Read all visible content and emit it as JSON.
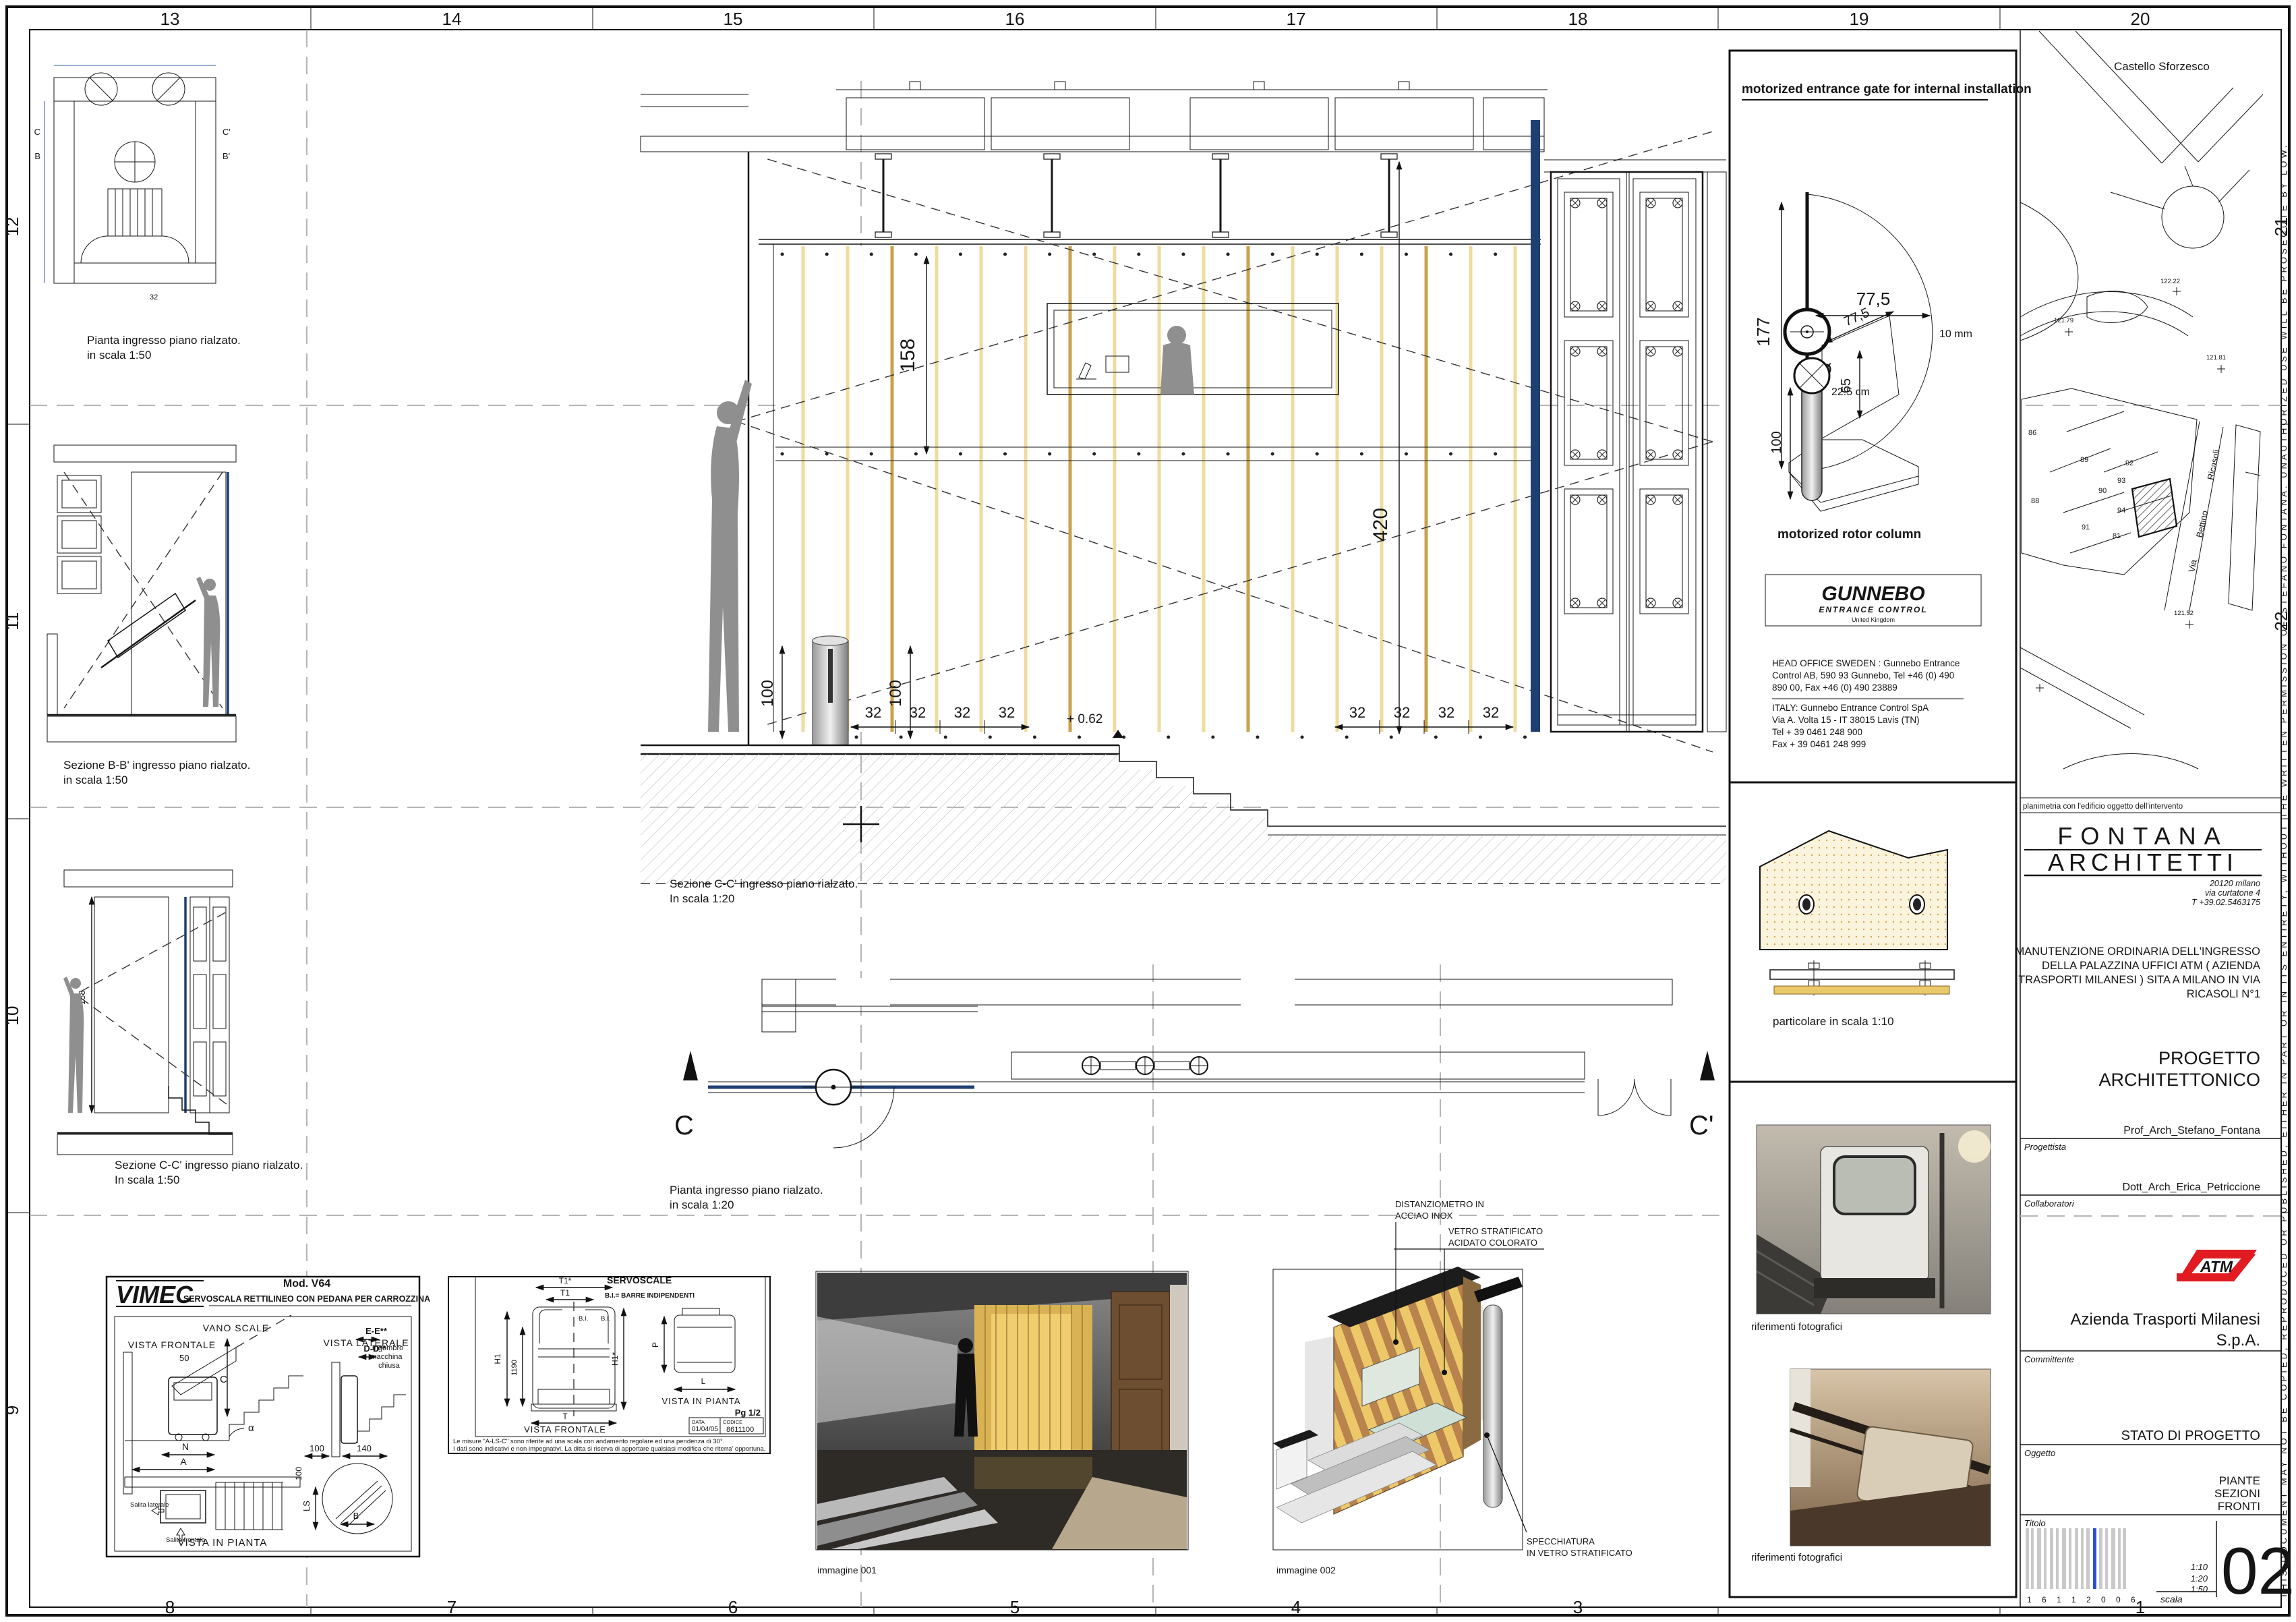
{
  "colors": {
    "plan_blue": "#2c5fae",
    "fin_blue": "#1d3f73",
    "gunnebo_blue": "#0a7cc4",
    "atm_red": "#e01b22",
    "glass_yellow": "#efdb9e",
    "barcode_blue": "#2b50d8"
  },
  "sheet": {
    "grid": {
      "top": [
        "13",
        "14",
        "15",
        "16",
        "17",
        "18",
        "19",
        "20"
      ],
      "bottom": [
        "8",
        "7",
        "6",
        "5",
        "4",
        "3",
        "1"
      ],
      "left": [
        "12",
        "11",
        "10",
        "9"
      ],
      "right": [
        "21",
        "22"
      ]
    },
    "notice": "THIS DOCUMENT MAY NOT BE COPIED, REPRODUCED OR PUBLISHED, EITHER IN PART OR IN ITS ENTIRETY, WITHOUT THE WRITTEN PERMISSION OF STEFANO FONTANA. UNAUTHORIZED USE WILL BE PROSECUTE BY LOW."
  },
  "left_col": {
    "plan50": {
      "cap1": "Pianta ingresso piano rialzato.",
      "cap2": "in scala 1:50",
      "m_c": "C",
      "m_b": "B",
      "m_c2": "C'",
      "m_b2": "B'",
      "dim32": "32"
    },
    "sezb": {
      "cap1": "Sezione B-B' ingresso piano rialzato.",
      "cap2": "in scala 1:50"
    },
    "sezc": {
      "cap1": "Sezione C-C' ingresso piano rialzato.",
      "cap2": "In scala 1:50",
      "dim158": "158"
    }
  },
  "center": {
    "section": {
      "cap1": "Sezione C-C' ingresso piano rialzato.",
      "cap2": "In scala 1:20",
      "dim158": "158",
      "dim420": "420",
      "dim100a": "100",
      "dim100b": "100",
      "d32": [
        "32",
        "32",
        "32",
        "32",
        "32",
        "32",
        "32",
        "32"
      ],
      "level": "+ 0.62"
    },
    "plan": {
      "cap1": "Pianta ingresso piano rialzato.",
      "cap2": "in scala 1:20",
      "mc": "C",
      "mc2": "C'"
    }
  },
  "images": {
    "img1": {
      "caption": "immagine 001"
    },
    "img2": {
      "caption": "immagine 002",
      "ann1a": "DISTANZIOMETRO IN",
      "ann1b": "ACCIAO INOX",
      "ann2a": "VETRO STRATIFICATO",
      "ann2b": "ACIDATO COLORATO",
      "ann3a": "SPECCHIATURA",
      "ann3b": "IN VETRO STRATIFICATO"
    }
  },
  "vimec": {
    "brand": "VIMEC",
    "model": "Mod. V64",
    "subtitle": "SERVOSCALA RETTILINEO CON PEDANA PER CARROZZINA",
    "vano": "VANO SCALE",
    "vfront": "VISTA FRONTALE",
    "vlat": "VISTA LATERALE",
    "ee": "E-E**",
    "dd": "D-D**",
    "ing1": "Ingombro",
    "ing2": "macchina",
    "ing3": "chiusa",
    "d50": "50",
    "dc": "C",
    "alpha": "α",
    "dn": "N",
    "da": "A",
    "d100a": "100",
    "d140": "140",
    "d100b": "100",
    "dls": "LS",
    "db": "B",
    "sal_lat": "Salita laterale",
    "sal_front": "Salita frontale",
    "vpianta": "VISTA IN PIANTA"
  },
  "servo": {
    "title": "SERVOSCALE",
    "bi": "B.I.= BARRE INDIPENDENTI",
    "t1s": "T1*",
    "t1": "T1",
    "bia": "B.I.",
    "bib": "B.I.",
    "h1": "H1",
    "d1190": "1190",
    "h1s": "H1*",
    "t": "T",
    "vfront": "VISTA FRONTALE",
    "p": "P",
    "l": "L",
    "vpianta": "VISTA IN PIANTA",
    "pg": "Pg 1/2",
    "data_l": "DATA",
    "data_v": "01/04/05",
    "cod_l": "CODICE",
    "cod_v": "8611100",
    "note1": "Le misure \"A-LS-C\" sono riferite ad una scala con andamento regolare ed una pendenza di 30°.",
    "note2": "I dati sono indicativi e non impegnativi. La ditta si riserva di apportare qualsiasi modifica che riterra' opportuna."
  },
  "gate": {
    "title": "motorized entrance gate for internal installation",
    "d775": "77,5",
    "d10mm": "10 mm",
    "d177": "177",
    "diam": "Ø",
    "d225": "22.5 cm",
    "a775": "77,5",
    "a65": "65",
    "a100": "100",
    "rotor": "motorized rotor column",
    "gunnebo": "GUNNEBO",
    "gsub": "ENTRANCE CONTROL",
    "guk": "United Kingdom",
    "sw1": "HEAD OFFICE SWEDEN : Gunnebo Entrance",
    "sw2": "Control AB, 590 93  Gunnebo, Tel +46 (0) 490",
    "sw3": "890 00, Fax +46 (0) 490 23889",
    "it1": "ITALY: Gunnebo Entrance Control SpA",
    "it2": "Via A. Volta 15 - IT 38015 Lavis (TN)",
    "it3": "Tel + 39 0461 248 900",
    "it4": "Fax + 39 0461 248 999"
  },
  "partic": {
    "caption": "particolare in scala 1:10"
  },
  "photos": {
    "cap1": "riferimenti fotografici",
    "cap2": "riferimenti fotografici"
  },
  "map": {
    "landmark": "Castello Sforzesco",
    "e1": "122.22",
    "e2": "121.79",
    "e3": "121.81",
    "e4": "121.52",
    "b": [
      "86",
      "89",
      "92",
      "93",
      "90",
      "88",
      "94",
      "91",
      "81"
    ],
    "s1": "Ricasoli",
    "s2": "Bettino",
    "s3": "Via",
    "caption": "planimetria con l'edificio oggetto dell'intervento"
  },
  "tb": {
    "studio1": "FONTANA",
    "studio2": "ARCHITETTI",
    "addr1": "20120 milano",
    "addr2": "via curtatone 4",
    "addr3": "T +39.02.5463175",
    "desc1": "MANUTENZIONE ORDINARIA DELL'INGRESSO",
    "desc2": "DELLA PALAZZINA UFFICI ATM ( AZIENDA",
    "desc3": "TRASPORTI MILANESI ) SITA A MILANO IN VIA",
    "desc4": "RICASOLI N°1",
    "proj1": "PROGETTO",
    "proj2": "ARCHITETTONICO",
    "prog_name": "Prof_Arch_Stefano_Fontana",
    "prog_label": "Progettista",
    "coll_name": "Dott_Arch_Erica_Petriccione",
    "coll_label": "Collaboratori",
    "atm": "ATM",
    "comm1": "Azienda Trasporti Milanesi",
    "comm2": "S.p.A.",
    "comm_label": "Committente",
    "stato": "STATO DI PROGETTO",
    "oggetto": "Oggetto",
    "tit1": "PIANTE",
    "tit2": "SEZIONI",
    "tit3": "FRONTI",
    "tit_label": "Titolo",
    "barcode": "1 6 1 1 2 0 0 6",
    "scala_label": "scala",
    "sc1": "1:10",
    "sc2": "1:20",
    "sc3": "1:50",
    "sheet": "02"
  }
}
